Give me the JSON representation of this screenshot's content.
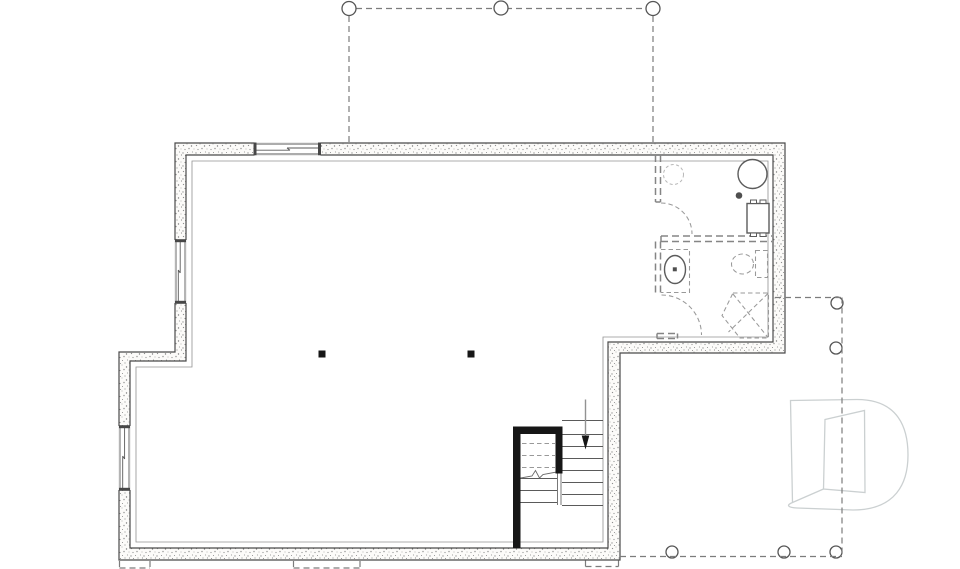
{
  "meta": {
    "title": "basement-floor-plan-drawing",
    "canvas": {
      "width": 960,
      "height": 569
    },
    "visible_text": ""
  },
  "colors": {
    "background": "#ffffff",
    "wall_line": "#4a4a4a",
    "stipple_dot": "#8f8f8f",
    "thin_line": "#5a5a5a",
    "dashed_line": "#7c7c7c",
    "partition_dash": "#858585",
    "stair_wall_black": "#161616",
    "watermark_gray": "#cbd0d1"
  },
  "legend": {
    "components": [
      "exterior-foundation-wall",
      "interior-offset-line",
      "window",
      "deck-above-dashed-outline",
      "deck-post",
      "steel-column",
      "staircase",
      "stair-down-arrow",
      "future-partition-dashed",
      "door-swing-arc",
      "water-tank",
      "floor-drain",
      "appliance",
      "future-vanity-sink",
      "future-toilet",
      "future-corner-shower",
      "window-well-dashed",
      "builder-logo-watermark"
    ]
  },
  "plan": {
    "shapes": [
      {
        "n": "interior-offset-line",
        "t": "path",
        "c": "offset",
        "a": {
          "d": "M192,161 H768 V337 H603 V542 H136 V367 H192 Z"
        }
      },
      {
        "n": "exterior-foundation-wall",
        "t": "path",
        "c": "wall",
        "a": {
          "d": "M175,143 H785 V353 H620 V560 H119 V352 H175 Z M186,155 H773 V342 H608 V548 H130 V361 H186 Z"
        }
      },
      {
        "n": "window-top-opening",
        "t": "rect",
        "c": "win",
        "a": {
          "x": 254.5,
          "y": 142.4,
          "width": 66,
          "height": 13.2
        }
      },
      {
        "n": "window-top-glazing",
        "t": "path",
        "c": "winl",
        "a": {
          "d": "M254.5,144 H320.5 M254.5,154 H320.5 M254.5,150.2 H290 M287,148 H320.5 M287,148 L290,150.2"
        }
      },
      {
        "n": "window-top-cap-left",
        "t": "rect",
        "c": "wincap",
        "a": {
          "x": 253.5,
          "y": 142.6,
          "width": 3,
          "height": 12.6
        }
      },
      {
        "n": "window-top-cap-right",
        "t": "rect",
        "c": "wincap",
        "a": {
          "x": 318,
          "y": 142.6,
          "width": 3,
          "height": 12.6
        }
      },
      {
        "n": "window-left-upper-opening",
        "t": "rect",
        "c": "win",
        "a": {
          "x": 174.4,
          "y": 240,
          "width": 12.2,
          "height": 63
        }
      },
      {
        "n": "window-left-upper-glazing",
        "t": "path",
        "c": "winl",
        "a": {
          "d": "M176,240.5 V302.5 M185,240.5 V302.5 M180.2,240.5 V273 M178.3,270 V302.5 M178.3,270 L180.2,273"
        }
      },
      {
        "n": "window-left-upper-cap-top",
        "t": "rect",
        "c": "wincap",
        "a": {
          "x": 175,
          "y": 239.2,
          "width": 11,
          "height": 3
        }
      },
      {
        "n": "window-left-upper-cap-bottom",
        "t": "rect",
        "c": "wincap",
        "a": {
          "x": 175,
          "y": 300.8,
          "width": 11,
          "height": 3
        }
      },
      {
        "n": "window-left-lower-opening",
        "t": "rect",
        "c": "win",
        "a": {
          "x": 118.4,
          "y": 426,
          "width": 12.2,
          "height": 64
        }
      },
      {
        "n": "window-left-lower-glazing",
        "t": "path",
        "c": "winl",
        "a": {
          "d": "M120,426.5 V489.5 M129,426.5 V489.5 M124.6,426.5 V459 M122.7,456 V489.5 M122.7,456 L124.6,459"
        }
      },
      {
        "n": "window-left-lower-cap-top",
        "t": "rect",
        "c": "wincap",
        "a": {
          "x": 119,
          "y": 425.2,
          "width": 11,
          "height": 3
        }
      },
      {
        "n": "window-left-lower-cap-bottom",
        "t": "rect",
        "c": "wincap",
        "a": {
          "x": 119,
          "y": 487.8,
          "width": 11,
          "height": 3
        }
      },
      {
        "n": "deck-above-dashed-outline-top",
        "t": "path",
        "c": "dash",
        "a": {
          "d": "M349,16 V142 M653,16 V142 M356,8.5 H646"
        }
      },
      {
        "n": "deck-post-top-left",
        "t": "circle",
        "c": "post",
        "a": {
          "cx": 349,
          "cy": 8.5,
          "r": 7
        }
      },
      {
        "n": "deck-post-top-middle",
        "t": "circle",
        "c": "post",
        "a": {
          "cx": 501,
          "cy": 8,
          "r": 7
        }
      },
      {
        "n": "deck-post-top-right",
        "t": "circle",
        "c": "post",
        "a": {
          "cx": 653,
          "cy": 8.5,
          "r": 7
        }
      },
      {
        "n": "steel-column-left",
        "t": "rect",
        "c": "blk",
        "a": {
          "x": 318.5,
          "y": 350.5,
          "width": 7,
          "height": 7
        }
      },
      {
        "n": "steel-column-right",
        "t": "rect",
        "c": "blk",
        "a": {
          "x": 467.5,
          "y": 350.5,
          "width": 7,
          "height": 7
        }
      },
      {
        "n": "stair-stringer",
        "t": "path",
        "c": "thin",
        "a": {
          "d": "M557.5,434 V505 M561,434 V505"
        }
      },
      {
        "n": "stair-treads-right-flight",
        "t": "path",
        "c": "winl",
        "a": {
          "d": "M562,420.5 H603 M562,434.5 H603 M562,446.5 H603 M562,458.5 H603 M562,470.5 H603 M562,482.5 H603 M562,494.5 H603 M562,505.5 H603"
        }
      },
      {
        "n": "stair-treads-left-flight",
        "t": "path",
        "c": "winl",
        "a": {
          "d": "M520,478.5 H557 M520,490.5 H557 M520,502.5 H557"
        }
      },
      {
        "n": "stair-header-dashed",
        "t": "path",
        "c": "dashf",
        "a": {
          "d": "M522,443.5 H555 M522,455.5 H555 M522,467.5 H555"
        }
      },
      {
        "n": "stair-break-line",
        "t": "polyline",
        "c": "thin",
        "a": {
          "points": "518,478.5 532,476 535.5,470.5 539.5,478 543,474.5 562,471"
        }
      },
      {
        "n": "stair-down-arrow-shaft",
        "t": "path",
        "c": "arr",
        "a": {
          "d": "M585.5,399.5 V436.5"
        }
      },
      {
        "n": "stair-down-arrow-head",
        "t": "polygon",
        "c": "blk",
        "a": {
          "points": "581.7,435.5 589.3,435.5 585.5,449.5"
        }
      },
      {
        "n": "stair-enclosure-wall",
        "t": "path",
        "c": "blk",
        "a": {
          "d": "M513,426.5 H562.5 V473.5 H555.5 V434 H520.5 V548 H513 Z"
        }
      },
      {
        "n": "future-partition-mech-left",
        "t": "path",
        "c": "part",
        "a": {
          "d": "M655.5,155 V202 M660.5,155 V202 M655.5,202 H660.5"
        }
      },
      {
        "n": "door-swing-arc-mech",
        "t": "path",
        "c": "dashf",
        "a": {
          "d": "M661,203 A31,31 0 0 1 692,234"
        }
      },
      {
        "n": "future-partition-mech-bath-divider",
        "t": "path",
        "c": "part",
        "a": {
          "d": "M661,236 H772 M661,241.5 H772 M661,236 V241.5"
        }
      },
      {
        "n": "future-partition-bath-left",
        "t": "path",
        "c": "part",
        "a": {
          "d": "M655.5,241.5 V293 M660.5,241.5 V293"
        }
      },
      {
        "n": "door-swing-arc-bath",
        "t": "path",
        "c": "dashf",
        "a": {
          "d": "M661.5,295 A40,40 0 0 1 701.5,335"
        }
      },
      {
        "n": "future-partition-bath-stub",
        "t": "path",
        "c": "part",
        "a": {
          "d": "M657,333.5 H677.5 M657,338.5 H677.5 M657,333.5 V338.5 M677.5,333.5 V338.5"
        }
      },
      {
        "n": "future-fixture-dashed-circle",
        "t": "circle",
        "c": "dashc",
        "a": {
          "cx": 673.5,
          "cy": 174.5,
          "r": 10
        }
      },
      {
        "n": "water-tank",
        "t": "circle",
        "c": "fix",
        "a": {
          "cx": 752.5,
          "cy": 174,
          "r": 14.5
        }
      },
      {
        "n": "floor-drain",
        "t": "circle",
        "c": "drk",
        "a": {
          "cx": 739,
          "cy": 195.5,
          "r": 3.3
        }
      },
      {
        "n": "appliance-body",
        "t": "rect",
        "c": "fix",
        "a": {
          "x": 747,
          "y": 203.5,
          "width": 22,
          "height": 29.5
        }
      },
      {
        "n": "appliance-tab-1",
        "t": "rect",
        "c": "fixt",
        "a": {
          "x": 750.5,
          "y": 200,
          "width": 6,
          "height": 3.5
        }
      },
      {
        "n": "appliance-tab-2",
        "t": "rect",
        "c": "fixt",
        "a": {
          "x": 760,
          "y": 200,
          "width": 6,
          "height": 3.5
        }
      },
      {
        "n": "appliance-tab-3",
        "t": "rect",
        "c": "fixt",
        "a": {
          "x": 750.5,
          "y": 233,
          "width": 6,
          "height": 3.5
        }
      },
      {
        "n": "appliance-tab-4",
        "t": "rect",
        "c": "fixt",
        "a": {
          "x": 760,
          "y": 233,
          "width": 6,
          "height": 3.5
        }
      },
      {
        "n": "future-vanity-counter",
        "t": "path",
        "c": "dashf",
        "a": {
          "d": "M661,249.5 H689.5 V292.5 H661"
        }
      },
      {
        "n": "future-sink-bowl",
        "t": "ellipse",
        "c": "fix",
        "a": {
          "cx": 675,
          "cy": 269.5,
          "rx": 10.5,
          "ry": 14
        }
      },
      {
        "n": "future-sink-drain-dot",
        "t": "rect",
        "c": "drk",
        "a": {
          "x": 672.8,
          "y": 267.3,
          "width": 4,
          "height": 4
        }
      },
      {
        "n": "future-toilet-bowl",
        "t": "ellipse",
        "c": "dashf",
        "a": {
          "cx": 742.5,
          "cy": 264,
          "rx": 11,
          "ry": 10
        }
      },
      {
        "n": "future-toilet-tank",
        "t": "rect",
        "c": "dashf",
        "a": {
          "x": 755.5,
          "y": 250.5,
          "width": 12,
          "height": 27
        }
      },
      {
        "n": "future-corner-shower-outline",
        "t": "path",
        "c": "dashf",
        "a": {
          "d": "M733,293 L768.5,293 L768.5,338 L740,338 L722,315.5 Z"
        }
      },
      {
        "n": "future-corner-shower-diagonals",
        "t": "path",
        "c": "dashf",
        "a": {
          "d": "M733,294 L768,337.5 M768,293.5 L728.5,332"
        }
      },
      {
        "n": "window-well-left",
        "t": "path",
        "c": "dash",
        "a": {
          "d": "M119.5,561 V568 M150,561 V568 M119.5,568 H150"
        }
      },
      {
        "n": "window-well-center",
        "t": "path",
        "c": "dash",
        "a": {
          "d": "M293.5,561 V568 M360,561 V568 M293.5,568 H360"
        }
      },
      {
        "n": "window-well-right",
        "t": "path",
        "c": "dash",
        "a": {
          "d": "M585.5,560.5 V566.5 M585.5,566.5 H618.5 M618.5,560.5 V566.5"
        }
      },
      {
        "n": "deck-post-right-1",
        "t": "circle",
        "c": "post",
        "a": {
          "cx": 837,
          "cy": 303,
          "r": 6
        }
      },
      {
        "n": "deck-post-right-2",
        "t": "circle",
        "c": "post",
        "a": {
          "cx": 836,
          "cy": 348,
          "r": 6
        }
      },
      {
        "n": "deck-post-right-3",
        "t": "circle",
        "c": "post",
        "a": {
          "cx": 837,
          "cy": 497,
          "r": 6
        }
      },
      {
        "n": "deck-post-bottom-1",
        "t": "circle",
        "c": "post",
        "a": {
          "cx": 672,
          "cy": 552,
          "r": 6
        }
      },
      {
        "n": "deck-post-bottom-2",
        "t": "circle",
        "c": "post",
        "a": {
          "cx": 784,
          "cy": 552,
          "r": 6
        }
      },
      {
        "n": "deck-post-bottom-3",
        "t": "circle",
        "c": "post",
        "a": {
          "cx": 836,
          "cy": 552,
          "r": 6
        }
      },
      {
        "n": "builder-logo-watermark",
        "t": "path",
        "c": "wm",
        "a": {
          "d": "M790.5,400.5 L857,399.5 C899,399.5 908,429 908,455 C908,483 896,510 853,510 L797,508 C787.5,507.5 786,505 792.5,502.5 L790.5,400.5 Z M825,419.5 L864.5,410.5 L865,492.5 L823.5,489 Z"
        }
      },
      {
        "n": "builder-logo-watermark-swoosh",
        "t": "path",
        "c": "wml",
        "a": {
          "d": "M792.5,502.5 L823.5,489"
        }
      },
      {
        "n": "deck-right-dashed-outline",
        "t": "path",
        "c": "dash",
        "a": {
          "d": "M775,297.5 H842 M842,297.5 V556.5 M620,556.5 H842"
        }
      }
    ]
  }
}
